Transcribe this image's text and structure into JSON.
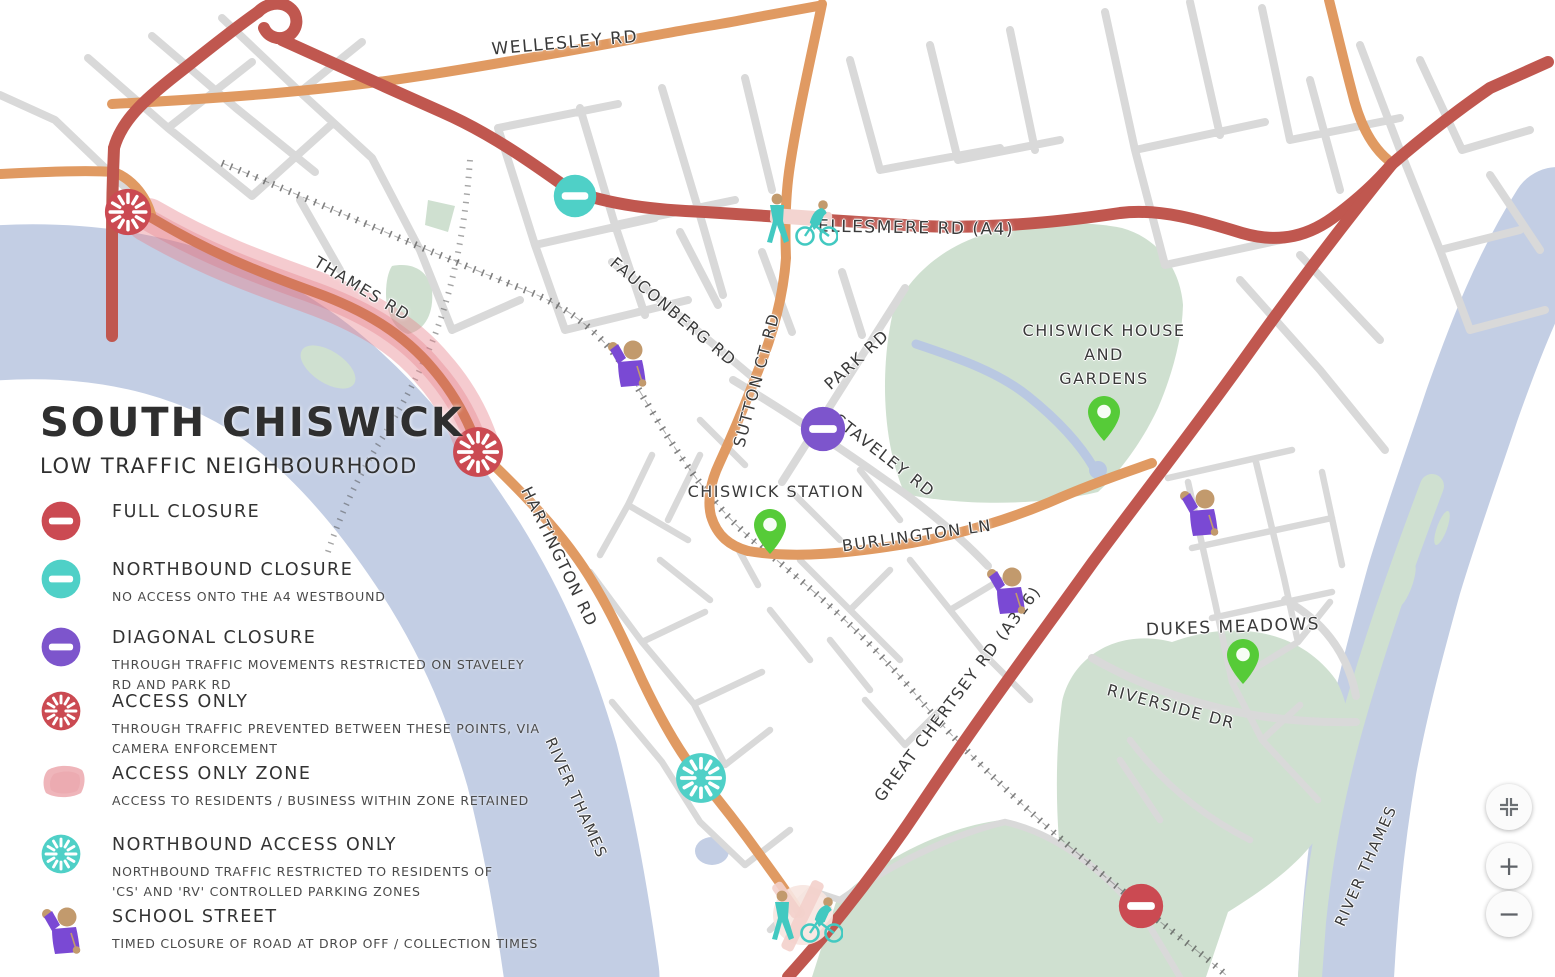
{
  "title": {
    "line1": "SOUTH CHISWICK",
    "line2": "LOW TRAFFIC NEIGHBOURHOOD"
  },
  "legend": {
    "items": [
      {
        "icon": "full-closure-icon",
        "label": "FULL CLOSURE",
        "sublabel": ""
      },
      {
        "icon": "northbound-closure-icon",
        "label": "NORTHBOUND CLOSURE",
        "sublabel": "NO ACCESS ONTO THE A4 WESTBOUND"
      },
      {
        "icon": "diagonal-closure-icon",
        "label": "DIAGONAL CLOSURE",
        "sublabel": "THROUGH TRAFFIC MOVEMENTS RESTRICTED ON STAVELEY RD AND PARK RD"
      },
      {
        "icon": "access-only-icon",
        "label": "ACCESS ONLY",
        "sublabel": "THROUGH TRAFFIC PREVENTED BETWEEN THESE POINTS, VIA CAMERA ENFORCEMENT"
      },
      {
        "icon": "access-only-zone-icon",
        "label": "ACCESS ONLY ZONE",
        "sublabel": "ACCESS TO RESIDENTS / BUSINESS WITHIN ZONE RETAINED"
      },
      {
        "icon": "northbound-access-only-icon",
        "label": "NORTHBOUND ACCESS ONLY",
        "sublabel": "NORTHBOUND TRAFFIC RESTRICTED TO RESIDENTS OF\n'CS' AND 'RV' CONTROLLED PARKING ZONES"
      },
      {
        "icon": "school-street-icon",
        "label": "SCHOOL STREET",
        "sublabel": "TIMED CLOSURE OF ROAD AT DROP OFF / COLLECTION TIMES"
      }
    ]
  },
  "colors": {
    "closure_red": "#cb4a52",
    "closure_teal": "#4fd0c7",
    "closure_purple": "#7d55cc",
    "zone_pink": "#efb5ba",
    "pin_green": "#56cb38",
    "person_purple": "#7a49d4",
    "skin_tan": "#c29a6d",
    "walk_teal": "#42c9c1",
    "road_major_red": "#c0574f",
    "road_orange": "#e09a62",
    "road_minor_gray": "#d9d9d9",
    "river_blue": "#c3cee4",
    "park_green": "#cfe0d0",
    "label_text": "#3a3a3a"
  },
  "map": {
    "labels": [
      {
        "kind": "road",
        "text": "WELLESLEY RD",
        "x": 565,
        "y": 44,
        "rotation": -5,
        "size": 17
      },
      {
        "kind": "road",
        "text": "ELLESMERE RD (A4)",
        "x": 916,
        "y": 229,
        "rotation": 1,
        "size": 17
      },
      {
        "kind": "road",
        "text": "THAMES RD",
        "x": 362,
        "y": 289,
        "rotation": 31,
        "size": 16
      },
      {
        "kind": "road",
        "text": "FAUCONBERG RD",
        "x": 673,
        "y": 312,
        "rotation": 40,
        "size": 16
      },
      {
        "kind": "road",
        "text": "SUTTON CT RD",
        "x": 757,
        "y": 380,
        "rotation": -75,
        "size": 16
      },
      {
        "kind": "road",
        "text": "PARK RD",
        "x": 857,
        "y": 360,
        "rotation": -42,
        "size": 16
      },
      {
        "kind": "road",
        "text": "STAVELEY RD",
        "x": 884,
        "y": 456,
        "rotation": 38,
        "size": 16
      },
      {
        "kind": "place",
        "text": "CHISWICK STATION",
        "x": 776,
        "y": 492,
        "rotation": 0,
        "size": 16
      },
      {
        "kind": "place",
        "text": "CHISWICK HOUSE\nAND\nGARDENS",
        "x": 1104,
        "y": 355,
        "rotation": 0,
        "size": 16
      },
      {
        "kind": "road",
        "text": "BURLINGTON LN",
        "x": 917,
        "y": 536,
        "rotation": -8,
        "size": 16
      },
      {
        "kind": "road",
        "text": "HARTINGTON RD",
        "x": 559,
        "y": 557,
        "rotation": 64,
        "size": 16
      },
      {
        "kind": "road",
        "text": "GREAT CHERTSEY RD (A316)",
        "x": 958,
        "y": 694,
        "rotation": -53,
        "size": 16
      },
      {
        "kind": "road",
        "text": "RIVERSIDE DR",
        "x": 1171,
        "y": 707,
        "rotation": 15,
        "size": 16
      },
      {
        "kind": "place",
        "text": "DUKES MEADOWS",
        "x": 1233,
        "y": 628,
        "rotation": -2,
        "size": 17
      },
      {
        "kind": "water",
        "text": "RIVER THAMES",
        "x": 576,
        "y": 798,
        "rotation": 66,
        "size": 15
      },
      {
        "kind": "water",
        "text": "RIVER THAMES",
        "x": 1366,
        "y": 866,
        "rotation": -66,
        "size": 15
      }
    ],
    "markers": [
      {
        "name": "northbound-closure-marker",
        "type": "closure-bar",
        "x": 575,
        "y": 196,
        "r": 23,
        "color": "closure_teal"
      },
      {
        "name": "diagonal-closure-marker",
        "type": "closure-bar",
        "x": 823,
        "y": 429,
        "r": 24,
        "color": "closure_purple"
      },
      {
        "name": "full-closure-marker",
        "type": "closure-bar",
        "x": 1141,
        "y": 906,
        "r": 24,
        "color": "closure_red"
      },
      {
        "name": "access-only-marker",
        "type": "spoke",
        "x": 128,
        "y": 212,
        "r": 25,
        "color": "closure_red"
      },
      {
        "name": "access-only-marker",
        "type": "spoke",
        "x": 478,
        "y": 452,
        "r": 27,
        "color": "closure_red"
      },
      {
        "name": "northbound-access-only-marker",
        "type": "spoke",
        "x": 701,
        "y": 778,
        "r": 27,
        "color": "closure_teal"
      },
      {
        "name": "chiswick-station-pin",
        "type": "pin",
        "x": 770,
        "y": 556
      },
      {
        "name": "chiswick-house-pin",
        "type": "pin",
        "x": 1104,
        "y": 443
      },
      {
        "name": "dukes-meadows-pin",
        "type": "pin",
        "x": 1243,
        "y": 686
      },
      {
        "name": "school-street-marker",
        "type": "person",
        "x": 628,
        "y": 363
      },
      {
        "name": "school-street-marker",
        "type": "person",
        "x": 1007,
        "y": 590
      },
      {
        "name": "school-street-marker",
        "type": "person",
        "x": 1200,
        "y": 512
      },
      {
        "name": "pedestrian-cycle-marker",
        "type": "walk-cycle",
        "x": 801,
        "y": 220
      },
      {
        "name": "pedestrian-cycle-marker",
        "type": "walk-cycle",
        "x": 806,
        "y": 917
      }
    ]
  },
  "controls": {
    "zoom_in": "+",
    "zoom_out": "−"
  }
}
